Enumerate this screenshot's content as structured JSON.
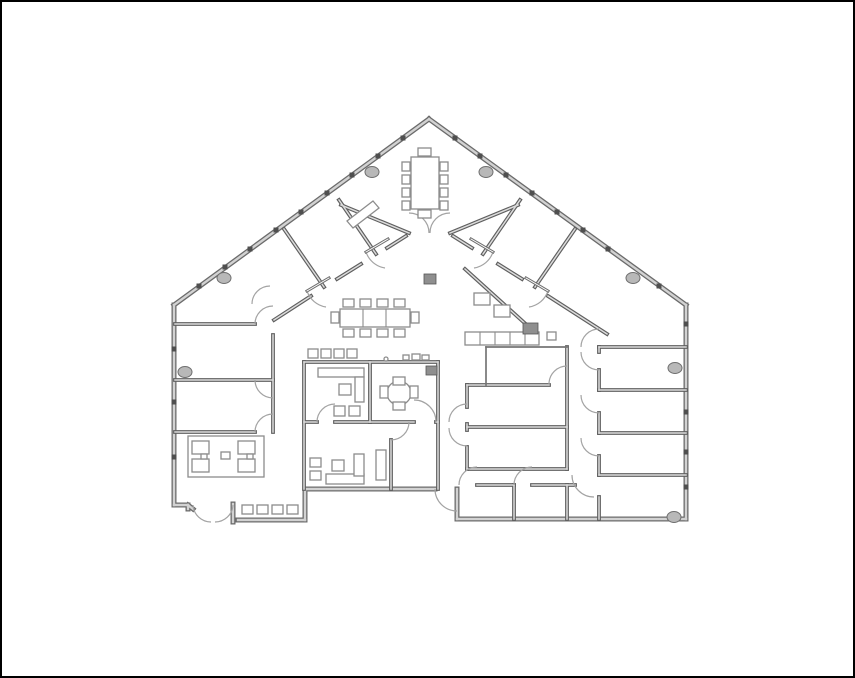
{
  "canvas": {
    "width": 855,
    "height": 678
  },
  "colors": {
    "background": "#ffffff",
    "frame": "#000000",
    "wall_edge": "#6b6b6b",
    "wall_core": "#d2d2d2",
    "thick_edge": "#5f5f5f",
    "thick_core": "#dcdcdc",
    "thin_wall": "#757575",
    "door_arc": "#a3a3a3",
    "door_leaf": "#6e6e6e",
    "furniture_stroke": "#8c8c8c",
    "furniture_fill": "#ffffff",
    "dark_block_fill": "#8f8f8f",
    "dark_block_edge": "#555555",
    "column_fill": "#b8b8b8",
    "column_edge": "#6e6e6e",
    "tick": "#4f4f4f"
  },
  "floorplan": {
    "exterior_walls": [
      [
        427,
        117,
        172,
        303
      ],
      [
        427,
        117,
        684,
        303
      ],
      [
        684,
        303,
        684,
        517
      ],
      [
        684,
        517,
        455,
        517
      ],
      [
        455,
        517,
        455,
        487
      ],
      [
        303,
        487,
        433,
        487
      ],
      [
        303,
        487,
        303,
        518
      ],
      [
        303,
        518,
        236,
        518
      ],
      [
        231,
        502,
        231,
        520
      ],
      [
        186,
        503,
        191,
        507
      ],
      [
        172,
        503,
        186,
        503
      ],
      [
        186,
        503,
        186,
        507
      ],
      [
        172,
        503,
        172,
        303
      ]
    ],
    "thick_walls": [
      [
        302,
        360,
        436,
        360
      ],
      [
        302,
        360,
        302,
        487
      ],
      [
        436,
        360,
        436,
        487
      ],
      [
        368,
        360,
        368,
        420
      ],
      [
        302,
        420,
        315,
        420
      ],
      [
        333,
        420,
        412,
        420
      ],
      [
        434,
        420,
        436,
        420
      ],
      [
        389,
        438,
        389,
        487
      ],
      [
        465,
        383,
        547,
        383
      ],
      [
        465,
        383,
        465,
        405
      ],
      [
        465,
        422,
        465,
        428
      ],
      [
        465,
        445,
        465,
        467
      ],
      [
        465,
        425,
        565,
        425
      ],
      [
        565,
        345,
        565,
        467
      ],
      [
        465,
        467,
        565,
        467
      ],
      [
        463,
        267,
        527,
        325
      ],
      [
        451,
        234,
        470,
        246
      ],
      [
        496,
        262,
        520,
        277
      ],
      [
        546,
        294,
        605,
        332
      ],
      [
        404,
        234,
        385,
        246
      ],
      [
        359,
        262,
        335,
        277
      ],
      [
        309,
        294,
        272,
        318
      ],
      [
        339,
        203,
        407,
        231
      ],
      [
        516,
        203,
        448,
        231
      ],
      [
        282,
        227,
        322,
        285
      ],
      [
        337,
        198,
        374,
        252
      ],
      [
        573,
        227,
        533,
        285
      ],
      [
        518,
        198,
        481,
        252
      ],
      [
        173,
        322,
        253,
        322
      ],
      [
        173,
        378,
        271,
        378
      ],
      [
        173,
        430,
        253,
        430
      ],
      [
        271,
        333,
        271,
        430
      ],
      [
        597,
        345,
        684,
        345
      ],
      [
        597,
        388,
        684,
        388
      ],
      [
        597,
        431,
        684,
        431
      ],
      [
        597,
        473,
        684,
        473
      ],
      [
        597,
        345,
        597,
        350
      ],
      [
        597,
        368,
        597,
        388
      ],
      [
        597,
        411,
        597,
        431
      ],
      [
        597,
        454,
        597,
        473
      ],
      [
        597,
        495,
        597,
        517
      ],
      [
        475,
        483,
        512,
        483
      ],
      [
        530,
        483,
        573,
        483
      ],
      [
        512,
        483,
        512,
        517
      ],
      [
        565,
        483,
        565,
        517
      ]
    ],
    "thin_walls": [
      [
        484,
        345,
        565,
        345
      ],
      [
        484,
        345,
        484,
        383
      ]
    ],
    "door_arcs": [
      {
        "s": [
          427,
          231
        ],
        "e": [
          407,
          211
        ],
        "r": 20,
        "w": 0
      },
      {
        "s": [
          428,
          231
        ],
        "e": [
          448,
          211
        ],
        "r": 20,
        "w": 1
      },
      {
        "s": [
          364,
          250
        ],
        "e": [
          383,
          266
        ],
        "r": 24,
        "w": 0
      },
      {
        "s": [
          305,
          289
        ],
        "e": [
          324,
          305
        ],
        "r": 24,
        "w": 0
      },
      {
        "s": [
          491,
          250
        ],
        "e": [
          472,
          266
        ],
        "r": 24,
        "w": 1
      },
      {
        "s": [
          546,
          289
        ],
        "e": [
          527,
          305
        ],
        "r": 24,
        "w": 1
      },
      {
        "s": [
          250,
          302
        ],
        "e": [
          268,
          284
        ],
        "r": 18,
        "w": 1
      },
      {
        "s": [
          253,
          322
        ],
        "e": [
          271,
          304
        ],
        "r": 18,
        "w": 1
      },
      {
        "s": [
          253,
          378
        ],
        "e": [
          271,
          396
        ],
        "r": 18,
        "w": 0
      },
      {
        "s": [
          253,
          430
        ],
        "e": [
          271,
          412
        ],
        "r": 18,
        "w": 1
      },
      {
        "s": [
          315,
          420
        ],
        "e": [
          333,
          402
        ],
        "r": 18,
        "w": 1
      },
      {
        "s": [
          434,
          420
        ],
        "e": [
          412,
          398
        ],
        "r": 22,
        "w": 0
      },
      {
        "s": [
          389,
          438
        ],
        "e": [
          407,
          420
        ],
        "r": 18,
        "w": 0
      },
      {
        "s": [
          433,
          487
        ],
        "e": [
          455,
          509
        ],
        "r": 22,
        "w": 0
      },
      {
        "s": [
          447,
          420
        ],
        "e": [
          465,
          402
        ],
        "r": 18,
        "w": 1
      },
      {
        "s": [
          447,
          426
        ],
        "e": [
          465,
          444
        ],
        "r": 18,
        "w": 0
      },
      {
        "s": [
          547,
          382
        ],
        "e": [
          565,
          364
        ],
        "r": 18,
        "w": 1
      },
      {
        "s": [
          579,
          345
        ],
        "e": [
          597,
          327
        ],
        "r": 18,
        "w": 1
      },
      {
        "s": [
          579,
          350
        ],
        "e": [
          597,
          368
        ],
        "r": 18,
        "w": 0
      },
      {
        "s": [
          579,
          393
        ],
        "e": [
          597,
          411
        ],
        "r": 18,
        "w": 0
      },
      {
        "s": [
          579,
          436
        ],
        "e": [
          597,
          454
        ],
        "r": 18,
        "w": 0
      },
      {
        "s": [
          570,
          473
        ],
        "e": [
          592,
          495
        ],
        "r": 22,
        "w": 0
      },
      {
        "s": [
          457,
          483
        ],
        "e": [
          475,
          465
        ],
        "r": 18,
        "w": 1
      },
      {
        "s": [
          512,
          483
        ],
        "e": [
          530,
          465
        ],
        "r": 18,
        "w": 1
      },
      {
        "s": [
          209,
          520
        ],
        "e": [
          191,
          503
        ],
        "r": 18,
        "w": 1
      },
      {
        "s": [
          213,
          520
        ],
        "e": [
          231,
          503
        ],
        "r": 18,
        "w": 0
      }
    ],
    "door_leaves": [
      [
        364,
        250,
        386,
        237
      ],
      [
        305,
        289,
        327,
        276
      ],
      [
        469,
        237,
        491,
        250
      ],
      [
        524,
        276,
        546,
        289
      ]
    ],
    "furniture": [
      {
        "name": "conference-table",
        "type": "rect",
        "xywh": [
          409,
          155,
          28,
          52
        ]
      },
      {
        "name": "conference-chair",
        "type": "rects",
        "items": [
          [
            400,
            160,
            8,
            9
          ],
          [
            400,
            173,
            8,
            9
          ],
          [
            400,
            186,
            8,
            9
          ],
          [
            400,
            199,
            8,
            9
          ],
          [
            438,
            160,
            8,
            9
          ],
          [
            438,
            173,
            8,
            9
          ],
          [
            438,
            186,
            8,
            9
          ],
          [
            438,
            199,
            8,
            9
          ],
          [
            416,
            146,
            13,
            8
          ],
          [
            416,
            208,
            13,
            8
          ]
        ]
      },
      {
        "name": "whiteboard",
        "type": "poly",
        "points": "345,219 371,199 377,206 351,226"
      },
      {
        "name": "break-table",
        "type": "rect",
        "xywh": [
          338,
          307,
          70,
          18
        ]
      },
      {
        "name": "break-table-divider",
        "type": "lines",
        "items": [
          [
            361,
            307,
            361,
            325
          ],
          [
            384,
            307,
            384,
            325
          ]
        ]
      },
      {
        "name": "break-chair",
        "type": "rects",
        "items": [
          [
            341,
            297,
            11,
            8
          ],
          [
            358,
            297,
            11,
            8
          ],
          [
            375,
            297,
            11,
            8
          ],
          [
            392,
            297,
            11,
            8
          ],
          [
            341,
            327,
            11,
            8
          ],
          [
            358,
            327,
            11,
            8
          ],
          [
            375,
            327,
            11,
            8
          ],
          [
            392,
            327,
            11,
            8
          ],
          [
            329,
            310,
            8,
            11
          ],
          [
            409,
            310,
            8,
            11
          ]
        ]
      },
      {
        "name": "counter-stool",
        "type": "rects",
        "items": [
          [
            306,
            347,
            10,
            9
          ],
          [
            319,
            347,
            10,
            9
          ],
          [
            332,
            347,
            10,
            9
          ],
          [
            345,
            347,
            10,
            9
          ]
        ]
      },
      {
        "name": "kitchen-appliance",
        "type": "rects",
        "items": [
          [
            401,
            353,
            6,
            5
          ],
          [
            410,
            352,
            8,
            6
          ],
          [
            420,
            353,
            7,
            5
          ]
        ]
      },
      {
        "name": "kitchen-knob",
        "type": "circle",
        "cxyr": [
          384,
          357,
          2
        ]
      },
      {
        "name": "office-desk",
        "type": "rects",
        "items": [
          [
            316,
            366,
            46,
            9
          ],
          [
            353,
            375,
            9,
            25
          ]
        ]
      },
      {
        "name": "office-chair",
        "type": "rects",
        "items": [
          [
            337,
            382,
            12,
            11
          ]
        ]
      },
      {
        "name": "guest-chair",
        "type": "rects",
        "items": [
          [
            332,
            404,
            11,
            10
          ],
          [
            347,
            404,
            11,
            10
          ]
        ]
      },
      {
        "name": "round-table",
        "type": "circle",
        "cxyr": [
          397,
          391,
          12
        ]
      },
      {
        "name": "round-table-chair",
        "type": "rects",
        "items": [
          [
            391,
            375,
            12,
            8
          ],
          [
            391,
            400,
            12,
            8
          ],
          [
            378,
            384,
            8,
            12
          ],
          [
            408,
            384,
            8,
            12
          ]
        ]
      },
      {
        "name": "office-desk",
        "type": "rects",
        "items": [
          [
            324,
            472,
            38,
            10
          ],
          [
            352,
            452,
            10,
            22
          ]
        ]
      },
      {
        "name": "office-chair",
        "type": "rects",
        "items": [
          [
            330,
            458,
            12,
            11
          ]
        ]
      },
      {
        "name": "guest-chair",
        "type": "rects",
        "items": [
          [
            308,
            456,
            11,
            9
          ],
          [
            308,
            469,
            11,
            9
          ]
        ]
      },
      {
        "name": "cabinet",
        "type": "rect",
        "xywh": [
          374,
          448,
          10,
          30
        ]
      },
      {
        "name": "lounge-rug",
        "type": "rect",
        "xywh": [
          186,
          434,
          76,
          41
        ]
      },
      {
        "name": "lounge-armchair",
        "type": "rects",
        "items": [
          [
            190,
            439,
            17,
            13
          ],
          [
            190,
            457,
            17,
            13
          ],
          [
            236,
            439,
            17,
            13
          ],
          [
            236,
            457,
            17,
            13
          ]
        ]
      },
      {
        "name": "lounge-table",
        "type": "rect",
        "xywh": [
          219,
          450,
          9,
          7
        ]
      },
      {
        "name": "lounge-side-table",
        "type": "rects",
        "items": [
          [
            199,
            452,
            6,
            5
          ],
          [
            245,
            452,
            6,
            5
          ]
        ]
      },
      {
        "name": "entry-chair",
        "type": "rects",
        "items": [
          [
            240,
            503,
            11,
            9
          ],
          [
            255,
            503,
            11,
            9
          ],
          [
            270,
            503,
            11,
            9
          ],
          [
            285,
            503,
            11,
            9
          ]
        ]
      },
      {
        "name": "storage-box",
        "type": "rects",
        "items": [
          [
            472,
            291,
            16,
            12
          ],
          [
            492,
            303,
            16,
            12
          ],
          [
            545,
            330,
            9,
            8
          ]
        ]
      },
      {
        "name": "cabinet-row",
        "type": "rect",
        "xywh": [
          463,
          330,
          74,
          13
        ]
      },
      {
        "name": "cabinet-row-divider",
        "type": "lines",
        "items": [
          [
            478,
            330,
            478,
            343
          ],
          [
            493,
            330,
            493,
            343
          ],
          [
            508,
            330,
            508,
            343
          ],
          [
            523,
            330,
            523,
            343
          ]
        ]
      }
    ],
    "dark_blocks": [
      [
        422,
        272,
        12,
        10
      ],
      [
        521,
        321,
        15,
        11
      ],
      [
        424,
        364,
        11,
        9
      ]
    ],
    "columns": [
      [
        222,
        276
      ],
      [
        370,
        170
      ],
      [
        484,
        170
      ],
      [
        631,
        276
      ],
      [
        183,
        370
      ],
      [
        673,
        366
      ],
      [
        672,
        515
      ]
    ],
    "wall_ticks": [
      [
        401,
        136
      ],
      [
        376,
        154
      ],
      [
        350,
        173
      ],
      [
        325,
        191
      ],
      [
        299,
        210
      ],
      [
        274,
        228
      ],
      [
        248,
        247
      ],
      [
        223,
        265
      ],
      [
        197,
        284
      ],
      [
        453,
        136
      ],
      [
        478,
        154
      ],
      [
        504,
        173
      ],
      [
        530,
        191
      ],
      [
        555,
        210
      ],
      [
        581,
        228
      ],
      [
        606,
        247
      ],
      [
        657,
        284
      ],
      [
        684,
        322
      ],
      [
        684,
        410
      ],
      [
        684,
        450
      ],
      [
        684,
        485
      ],
      [
        172,
        347
      ],
      [
        172,
        400
      ],
      [
        172,
        455
      ]
    ]
  }
}
